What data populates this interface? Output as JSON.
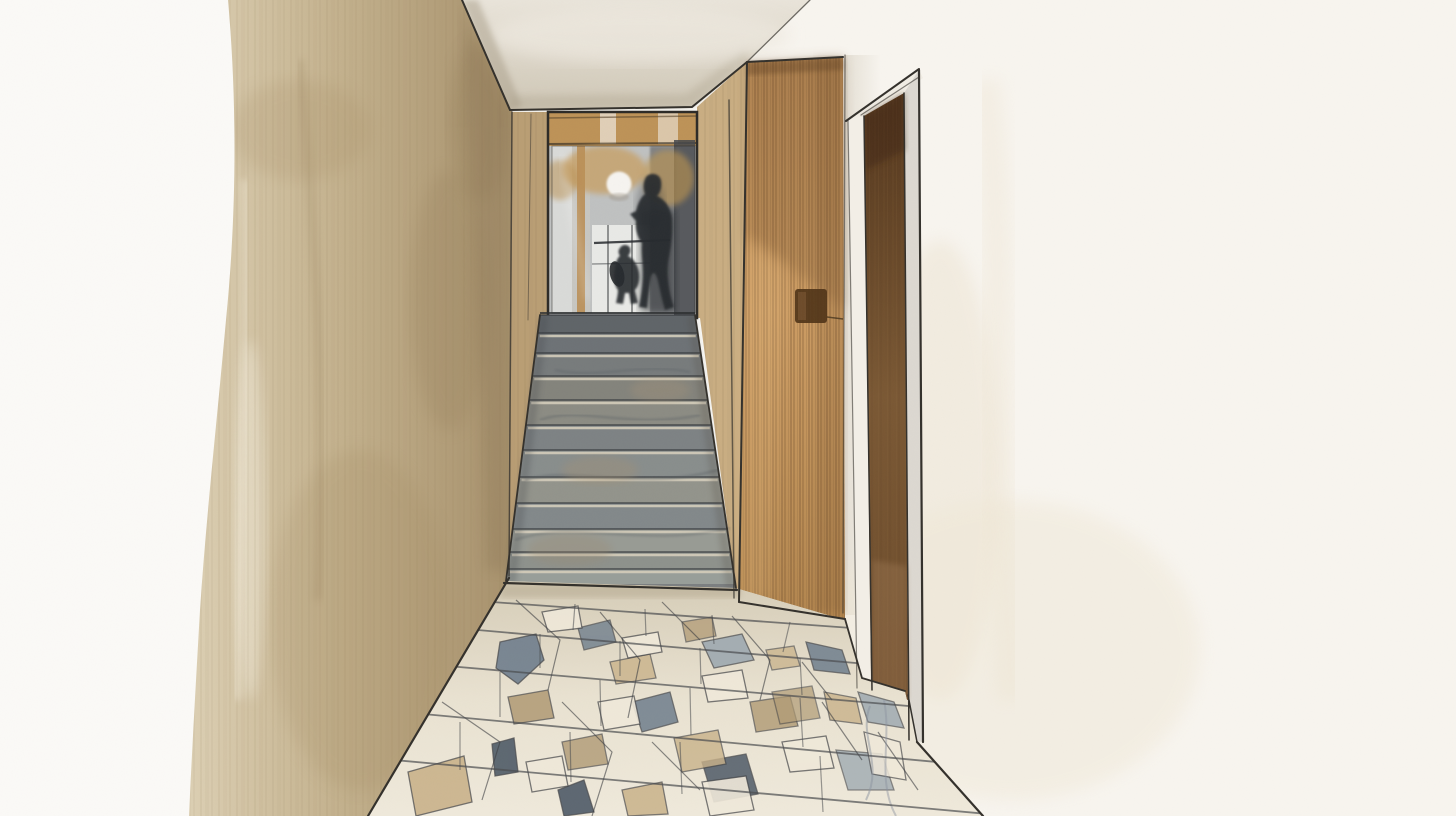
{
  "meta": {
    "title": "Watercolor architectural illustration of a narrow hallway with marble stairs, wood partition, doorway and cracked-marble floor",
    "style": "watercolor-and-pencil sketch",
    "no_visible_text": true
  },
  "scene": {
    "regions": [
      {
        "name": "left-wall",
        "material": "beige watercolor wash"
      },
      {
        "name": "ceiling",
        "material": "grey-beige wash"
      },
      {
        "name": "mirror-landing",
        "material": "glass reflection with wood beams"
      },
      {
        "name": "staircase",
        "material": "grey marble steps"
      },
      {
        "name": "wood-partition",
        "material": "oak vertical grain panel"
      },
      {
        "name": "right-wall",
        "material": "white plaster"
      },
      {
        "name": "doorway",
        "material": "dark walnut reveal"
      },
      {
        "name": "floor",
        "material": "cracked marble / stone shard tiles"
      }
    ],
    "figures": [
      {
        "name": "adult-silhouette",
        "pose": "walking, seen in mirror at top of stairs"
      },
      {
        "name": "child-silhouette",
        "pose": "standing with rounded backpack"
      }
    ],
    "light": {
      "name": "round-wall-light",
      "shape": "white circle"
    }
  },
  "palette": {
    "paper": "#fbfaf7",
    "pencil": "#33302b",
    "leftwall_light": "#d8cbae",
    "leftwall_mid": "#bfac88",
    "leftwall_dark": "#9c8665",
    "ceiling_light": "#e9e4da",
    "ceiling_dark": "#cfc7b6",
    "rightwall": "#f8f5ef",
    "rightwall_wash": "#ece3d1",
    "wood_light": "#cc9c63",
    "wood_dark": "#b98b52",
    "wood_grain": "#6f4d2a",
    "door_brown": "#5f3f22",
    "frame_grey": "#dcd8d1",
    "glass": "#bfc1c1",
    "glass_dark": "#44474b",
    "ochre": "#c89f62",
    "ink": "#26292d",
    "floor_base": "#e7dfcc",
    "tile_cream": "#f0e9da",
    "tile_beige": "#c9b28a",
    "tile_tan": "#b09a74",
    "tile_slate": "#6e7d8c",
    "tile_slate_dark": "#4e5a67",
    "tile_grey": "#9aa6af",
    "outline": "#3c3e41"
  },
  "stairs": {
    "count": 12,
    "y_boundaries": [
      315,
      333,
      353,
      376,
      400,
      425,
      450,
      477,
      503,
      529,
      552,
      569,
      584
    ],
    "left_top_x": 540,
    "left_bottom_x": 506,
    "right_top_x": 695,
    "right_bottom_x": 736,
    "colors": [
      "#5f6468",
      "#6d7276",
      "#777b7c",
      "#83837c",
      "#8b8b83",
      "#7d8284",
      "#888d8c",
      "#92938b",
      "#82888a",
      "#989b94",
      "#8d918c",
      "#989e99"
    ],
    "nosing_color": "#d4cdbb",
    "edge_color": "#33363a"
  }
}
